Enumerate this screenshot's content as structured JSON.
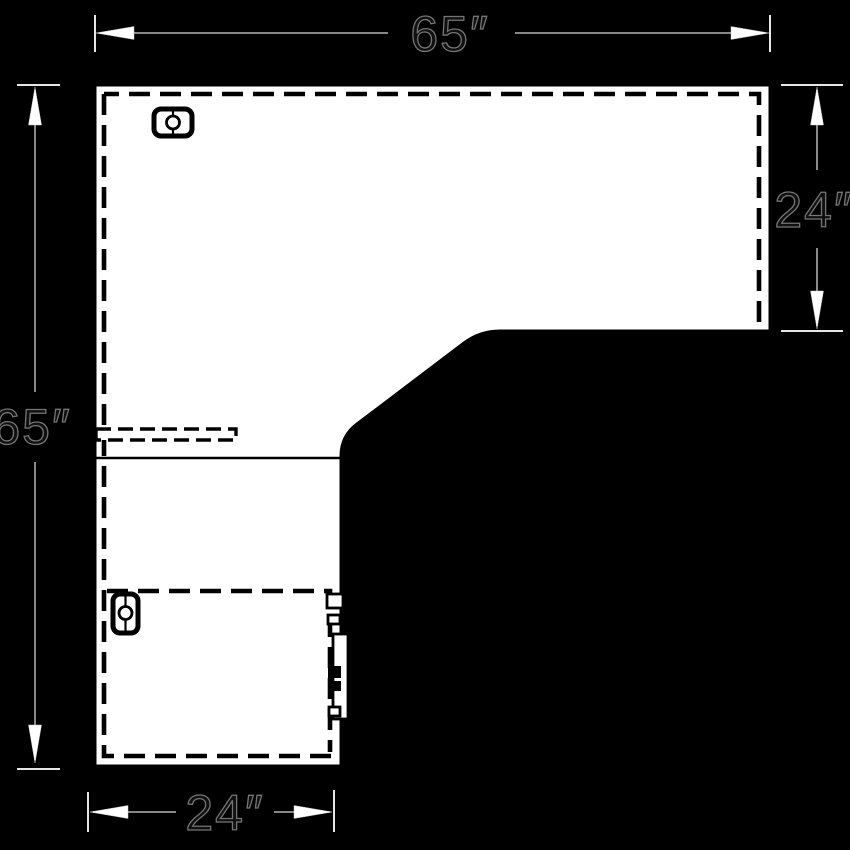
{
  "drawing": {
    "type": "l-shaped-desk-plan-view",
    "dims": {
      "top": "65″",
      "right": "24″",
      "left": "65″",
      "bottom": "24″"
    },
    "colors": {
      "background": "#000000",
      "surface_fill": "#ffffff",
      "linework": "#000000",
      "dimension_line": "#9a9a9a",
      "extension_line": "#e6e6e6",
      "arrowhead": "#ffffff",
      "dimension_text_fill": "#101010",
      "dimension_text_outline": "#757575"
    }
  }
}
